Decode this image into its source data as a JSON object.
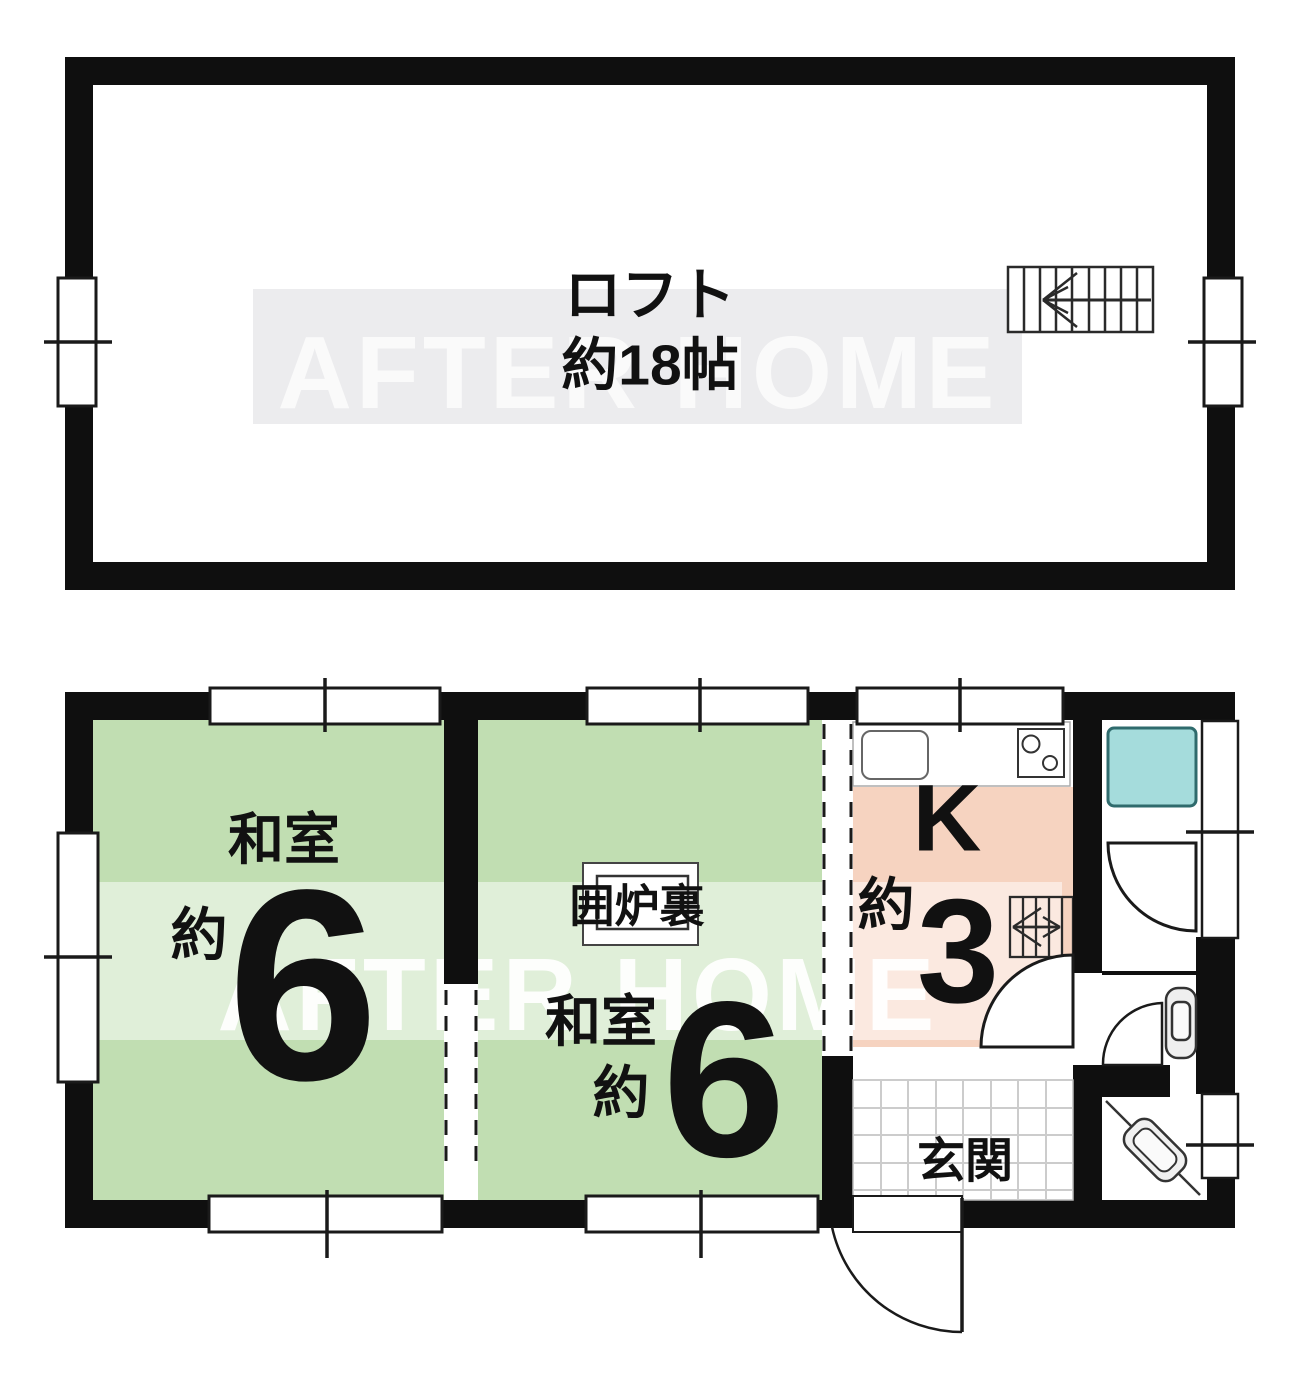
{
  "watermark": {
    "text": "AFTER HOME"
  },
  "loft": {
    "label": "ロフト",
    "area": "約18帖"
  },
  "first_floor": {
    "tatami_room_left": {
      "label": "和室",
      "approx": "約",
      "tatami_count": "6"
    },
    "tatami_room_center": {
      "label": "和室",
      "approx": "約",
      "tatami_count": "6",
      "hearth_label": "囲炉裏"
    },
    "kitchen": {
      "label": "K",
      "approx": "約",
      "tatami_count": "3"
    },
    "entrance": {
      "label": "玄関"
    }
  },
  "colors": {
    "wall": "#0f0f0f",
    "tatami_green": "#c1deb2",
    "kitchen_pink": "#f6d3c0",
    "bath_cyan": "#a5dcdc",
    "bath_border": "#2f6b6d",
    "watermark_band": "#ececee",
    "watermark_letters": "#fafafa",
    "tile_line": "#cccccc"
  }
}
